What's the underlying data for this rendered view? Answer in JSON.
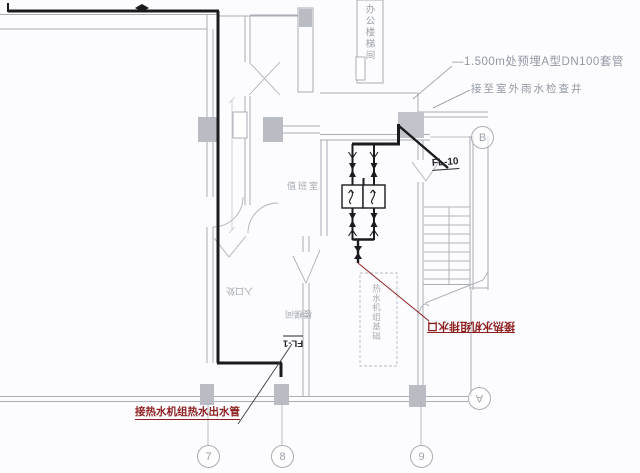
{
  "drawing": {
    "annotations": {
      "sleeve_note": "—1.500m处预埋A型DN100套管",
      "outdoor_note": "接至室外雨水检查井",
      "riser_fl10": "FL-10",
      "riser_fl1": "FL-1",
      "drain_label": "接热水机组排水口",
      "outlet_label": "接热水机组热水出水管"
    },
    "rooms": {
      "duty_room": "值班室",
      "shaft_label": "办公楼梯间",
      "entry_label": "入口处",
      "stair_label": "楼梯间",
      "pad_label": "热水机组基础"
    },
    "grid": {
      "bottom": [
        "7",
        "8",
        "9"
      ],
      "right_top": "B",
      "right_bottom": "A"
    },
    "colors": {
      "pipe": "#1b1b1f",
      "wall": "#a9adb5",
      "column": "#b9bcc2",
      "red": "#8e1f1f",
      "note_gray": "#9298a3"
    }
  }
}
